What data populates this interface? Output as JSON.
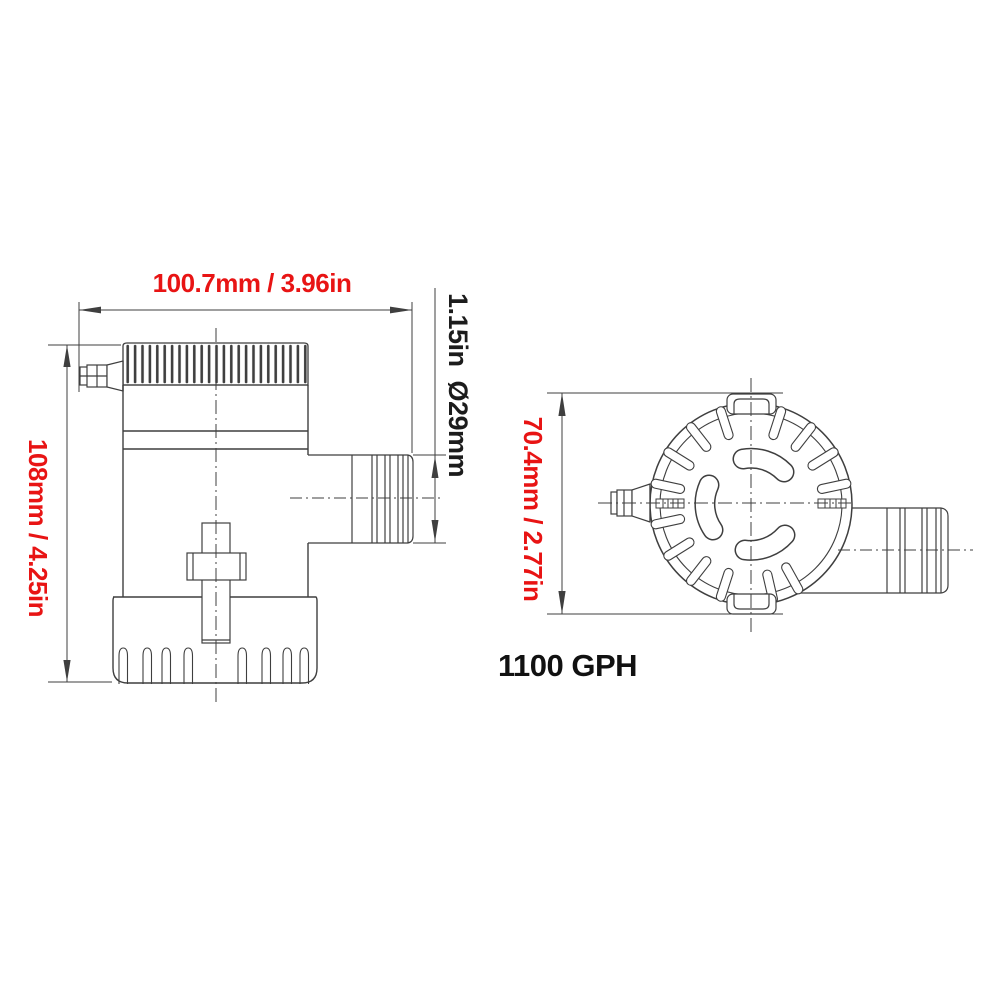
{
  "labels": {
    "front_width": "100.7mm / 3.96in",
    "front_height": "108mm / 4.25in",
    "outlet_diameter": "1.15in  Ø29mm",
    "top_height": "70.4mm / 2.77in",
    "flow_rating": "1100 GPH"
  },
  "colors": {
    "dimension_text_red": "#e81414",
    "drawing_line_gray": "#3f3f3f",
    "rating_text_black": "#111111",
    "background": "#ffffff"
  }
}
